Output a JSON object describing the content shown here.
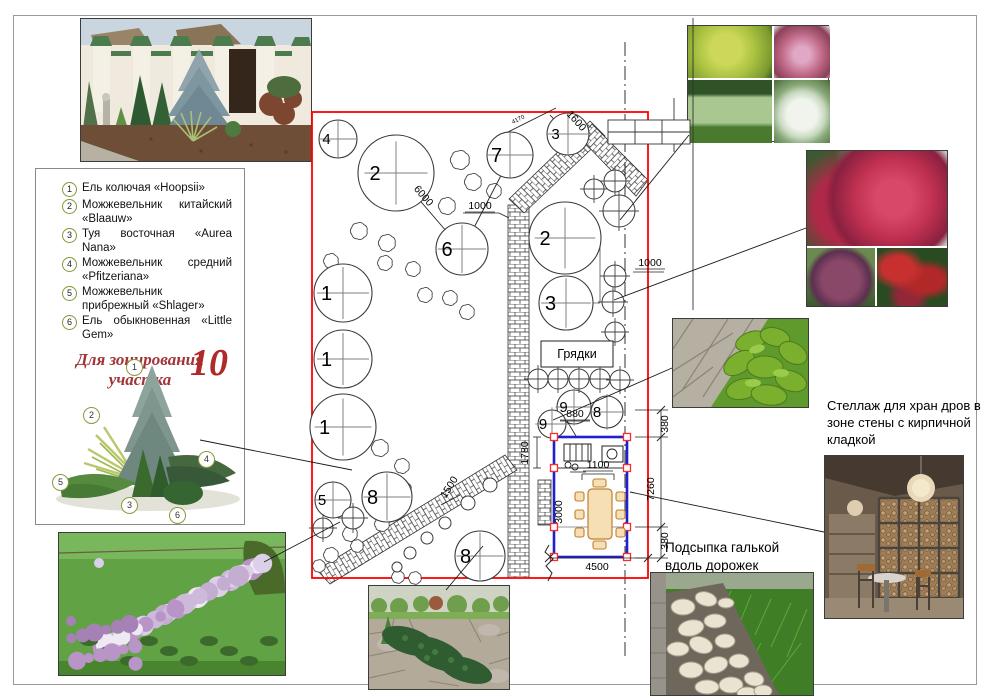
{
  "legend": {
    "items": [
      {
        "num": "1",
        "text": "Ель колючая «Hoopsii»"
      },
      {
        "num": "2",
        "text": "Можжевельник китайский «Blaauw»"
      },
      {
        "num": "3",
        "text": "Туя восточная «Aurea Nana»"
      },
      {
        "num": "4",
        "text": "Можжевельник средний «Pfitzeriana»"
      },
      {
        "num": "5",
        "text": "Можжевельник прибрежный «Shlager»"
      },
      {
        "num": "6",
        "text": "Ель обыкновенная «Little Gem»"
      }
    ],
    "title_line1": "Для зонирования",
    "title_line2": "участка",
    "sheet_number": "10",
    "badge_positions": [
      {
        "n": "1",
        "x": 78,
        "y": 2
      },
      {
        "n": "2",
        "x": 35,
        "y": 50
      },
      {
        "n": "4",
        "x": 150,
        "y": 94
      },
      {
        "n": "5",
        "x": 4,
        "y": 117
      },
      {
        "n": "3",
        "x": 73,
        "y": 140
      },
      {
        "n": "6",
        "x": 121,
        "y": 150
      }
    ]
  },
  "plan": {
    "border_color": "#ff0000",
    "beds_label": "Грядки",
    "pavilion_color": "#2020cc",
    "post_color": "#ff2a2a",
    "circles": [
      {
        "n": "4",
        "x": 338,
        "y": 139,
        "r": 19
      },
      {
        "n": "2",
        "x": 396,
        "y": 173,
        "r": 38
      },
      {
        "n": "7",
        "x": 510,
        "y": 155,
        "r": 23
      },
      {
        "n": "3",
        "x": 568,
        "y": 134,
        "r": 21
      },
      {
        "n": "6",
        "x": 462,
        "y": 249,
        "r": 26
      },
      {
        "n": "1",
        "x": 343,
        "y": 293,
        "r": 29
      },
      {
        "n": "1",
        "x": 343,
        "y": 359,
        "r": 29
      },
      {
        "n": "1",
        "x": 343,
        "y": 427,
        "r": 33
      },
      {
        "n": "2",
        "x": 565,
        "y": 238,
        "r": 36
      },
      {
        "n": "3",
        "x": 566,
        "y": 303,
        "r": 27
      },
      {
        "n": "5",
        "x": 333,
        "y": 500,
        "r": 18
      },
      {
        "n": "8",
        "x": 387,
        "y": 497,
        "r": 25
      },
      {
        "n": "8",
        "x": 480,
        "y": 556,
        "r": 25
      },
      {
        "n": "9",
        "x": 574,
        "y": 407,
        "r": 17
      },
      {
        "n": "9",
        "x": 552,
        "y": 424,
        "r": 14
      },
      {
        "n": "8",
        "x": 607,
        "y": 412,
        "r": 16
      }
    ],
    "small_cross_circles": [
      [
        538,
        379,
        10
      ],
      [
        558,
        379,
        10
      ],
      [
        579,
        379,
        10
      ],
      [
        600,
        379,
        10
      ],
      [
        620,
        380,
        10
      ],
      [
        594,
        189,
        10
      ],
      [
        615,
        181,
        11
      ],
      [
        619,
        211,
        16
      ],
      [
        615,
        276,
        11
      ],
      [
        613,
        302,
        11
      ],
      [
        615,
        332,
        10
      ],
      [
        353,
        518,
        11
      ],
      [
        323,
        528,
        10
      ]
    ],
    "plain_circles": [
      [
        490,
        485,
        7
      ],
      [
        468,
        503,
        7
      ],
      [
        445,
        523,
        6
      ],
      [
        427,
        538,
        6
      ],
      [
        410,
        553,
        6
      ],
      [
        397,
        567,
        5
      ]
    ],
    "dimensions": [
      {
        "t": "6000",
        "x": 421,
        "y": 198,
        "r": 49
      },
      {
        "t": "1000",
        "x": 480,
        "y": 209,
        "r": 0,
        "u": true
      },
      {
        "t": "1600",
        "x": 574,
        "y": 123,
        "r": 48
      },
      {
        "t": "4170",
        "x": 519,
        "y": 121,
        "r": -27,
        "s": 6
      },
      {
        "t": "1000",
        "x": 650,
        "y": 266,
        "r": 0,
        "u": true
      },
      {
        "t": "880",
        "x": 575,
        "y": 417,
        "r": 0,
        "u": true
      },
      {
        "t": "1780",
        "x": 528,
        "y": 453,
        "r": -90
      },
      {
        "t": "1100",
        "x": 598,
        "y": 468,
        "r": 0,
        "u": true
      },
      {
        "t": "3000",
        "x": 562,
        "y": 512,
        "r": -90
      },
      {
        "t": "380",
        "x": 668,
        "y": 424,
        "r": -90
      },
      {
        "t": "7260",
        "x": 654,
        "y": 489,
        "r": -90
      },
      {
        "t": "380",
        "x": 668,
        "y": 541,
        "r": -90
      },
      {
        "t": "4500",
        "x": 597,
        "y": 570,
        "r": 0
      },
      {
        "t": "1500",
        "x": 452,
        "y": 489,
        "r": -58
      }
    ]
  },
  "annotations": {
    "firewood": "Стеллаж для хран дров в зоне стены с кирпичной кладкой",
    "pebbles": "Подсыпка галькой вдоль дорожек"
  }
}
